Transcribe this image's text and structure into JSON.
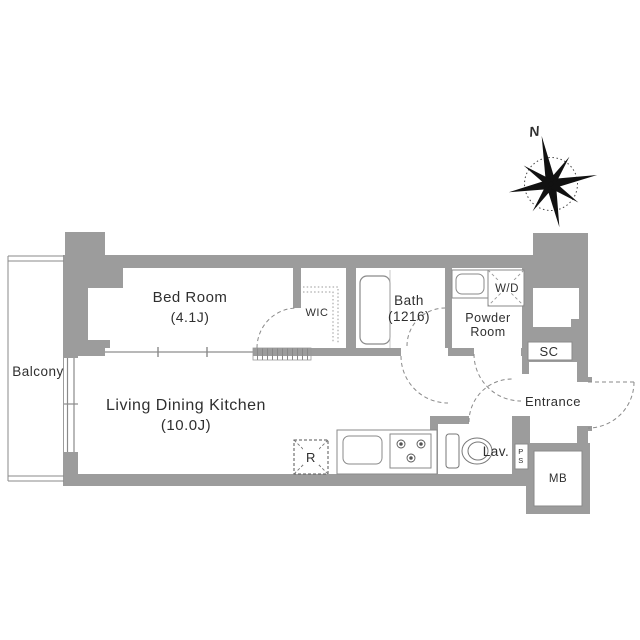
{
  "plan": {
    "compass": {
      "north_label": "N"
    },
    "rooms": {
      "bedroom": {
        "name": "Bed Room",
        "size": "(4.1J)"
      },
      "ldk": {
        "name": "Living Dining Kitchen",
        "size": "(10.0J)"
      },
      "balcony": {
        "name": "Balcony"
      },
      "wic": {
        "name": "WIC"
      },
      "bath": {
        "name": "Bath",
        "size": "(1216)"
      },
      "powder_room": {
        "line1": "Powder",
        "line2": "Room"
      },
      "washer_dryer": {
        "name": "W/D"
      },
      "shoe_closet": {
        "name": "SC"
      },
      "entrance": {
        "name": "Entrance"
      },
      "lavatory": {
        "name": "Lav."
      },
      "pipe_space": {
        "letter1": "P",
        "letter2": "S"
      },
      "meter_box": {
        "name": "MB"
      },
      "refrigerator": {
        "name": "R"
      }
    },
    "colors": {
      "wall": "#9c9c9c",
      "line": "#8a8a8a",
      "text": "#2f2f2f"
    }
  }
}
